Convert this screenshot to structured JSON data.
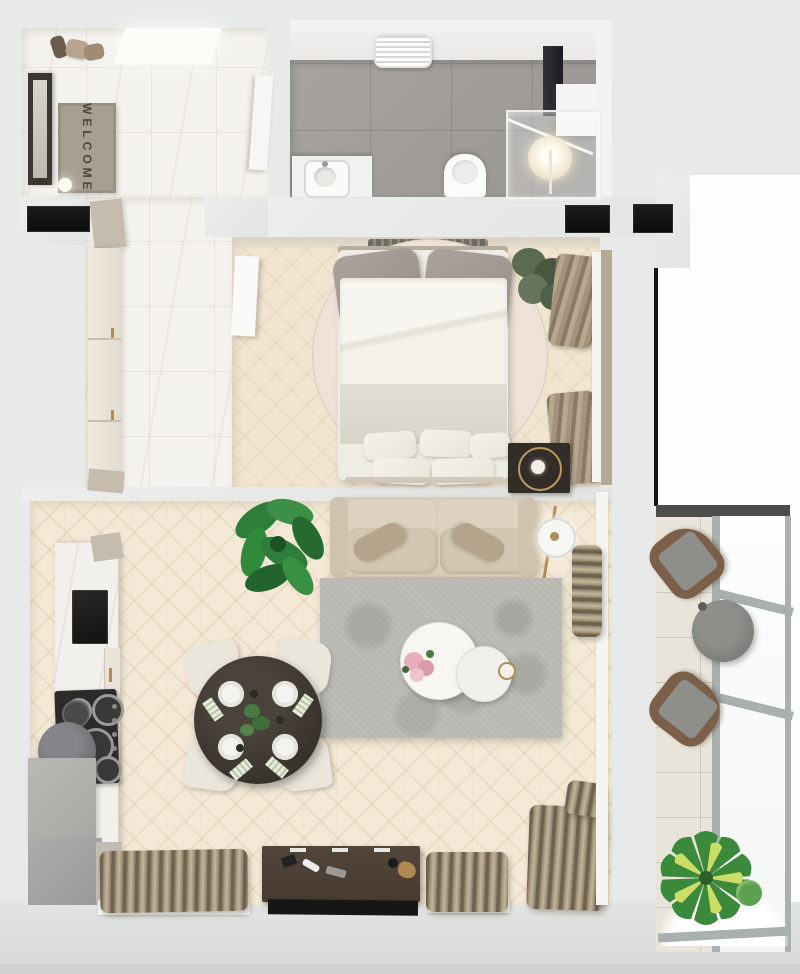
{
  "labels": {
    "welcome_mat": "WELCOME"
  },
  "palette": {
    "wall": "#e8eae9",
    "wall_dark": "#d8dad9",
    "floor_marble": "#f4f2ee",
    "floor_wood": "#f4e9d7",
    "floor_bed": "#f1e5d2",
    "bath_floor": "#a09d9a",
    "mat": "#a89f93",
    "mat_text": "#51463a",
    "black_panel": "#141414",
    "accent_gold": "#b08d57",
    "sofa": "#d8ccba",
    "rug_gray": "#b9b8b3",
    "rug_round": "#ecdfd4",
    "table_dark": "#39332d",
    "console": "#473b30",
    "tv": "#161616",
    "curtain_light": "#c3b49a",
    "curtain_dark": "#6e6252",
    "counter": "#f2f0ec",
    "cooktop": "#2c2b29",
    "hood": "#707074",
    "balcony_floor": "#e9e4d9",
    "wicker": "#7b5f49",
    "cushion_gray": "#8e8e8b",
    "plant_green": "#2e7d3a",
    "plant_dark": "#5a6b52",
    "frame_gray": "#aab0b0"
  },
  "rooms": {
    "entry": {
      "items": [
        "entrance-door",
        "welcome-mat",
        "coat-rack",
        "ceiling-light-panel",
        "wall-lamp",
        "tall-cabinet"
      ]
    },
    "hallway": {
      "items": [
        "wardrobe-cabinets"
      ]
    },
    "bathroom": {
      "items": [
        "towel-dryer",
        "vanity-sink",
        "toilet",
        "shower-cabin",
        "washing-machine",
        "storage-cabinet"
      ]
    },
    "bedroom": {
      "items": [
        "double-bed",
        "round-rug",
        "radiator",
        "potted-plant",
        "curtain-stacks",
        "mirror-strip",
        "nightstand-clock",
        "open-door"
      ]
    },
    "living_room": {
      "items": [
        "monstera-plant",
        "sofa",
        "floor-lamp",
        "area-rug",
        "nesting-coffee-tables",
        "flower-vase",
        "dining-table",
        "dining-chairs",
        "place-settings",
        "kitchen-counter",
        "kitchen-sink-panel",
        "cooktop-burners",
        "range-hood",
        "kitchen-cabinets",
        "tv-console",
        "tv",
        "window-curtains",
        "window-sills"
      ]
    },
    "balcony": {
      "items": [
        "lounge-chair-north",
        "lounge-chair-south",
        "round-side-table",
        "variegated-plant",
        "glazed-window-wall"
      ]
    }
  }
}
